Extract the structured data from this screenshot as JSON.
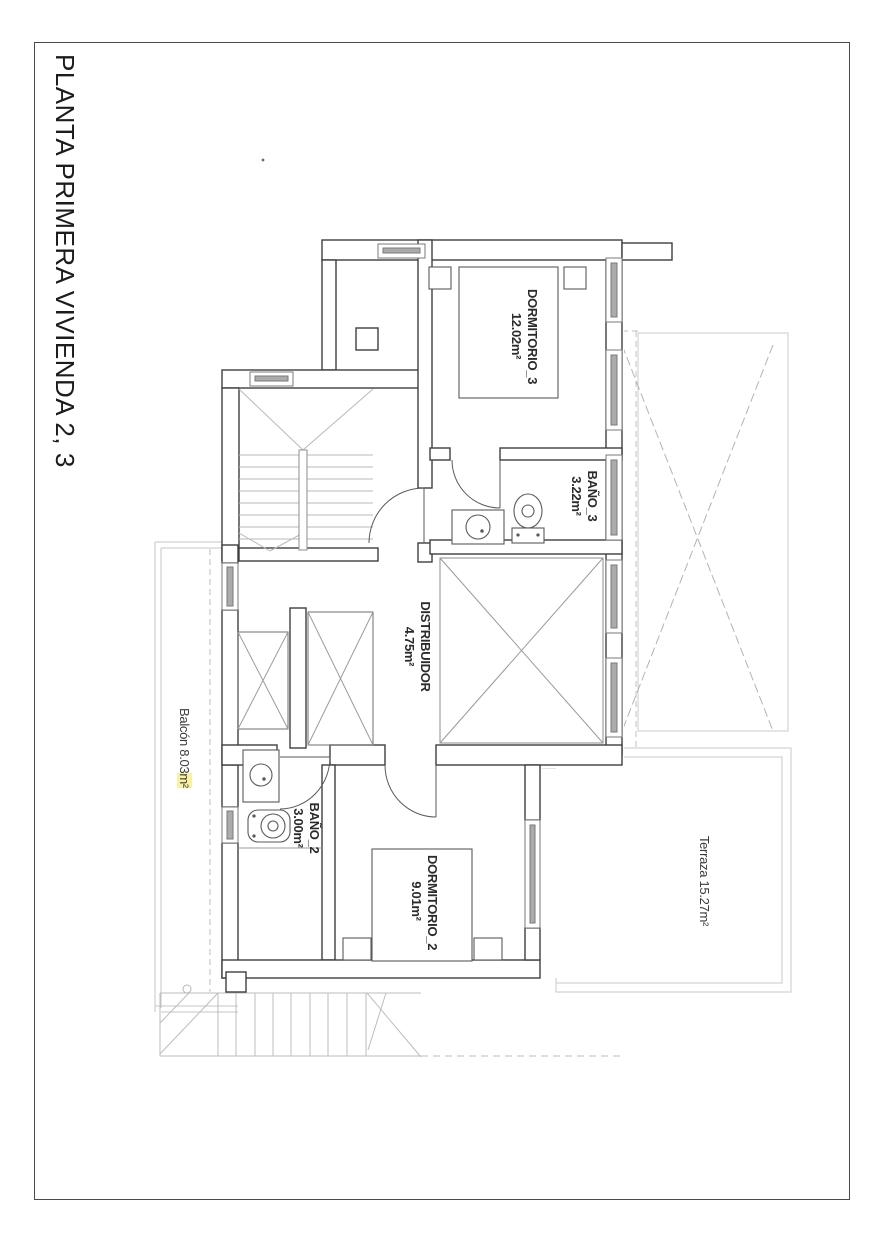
{
  "page": {
    "title": "PLANTA PRIMERA VIVIENDA 2, 3"
  },
  "rooms": {
    "dormitorio3": {
      "name": "DORMITORIO_3",
      "area": "12.02m²"
    },
    "bano3": {
      "name": "BAÑO_3",
      "area": "3.22m²"
    },
    "distribuidor": {
      "name": "DISTRIBUIDOR",
      "area": "4.75m²"
    },
    "bano2": {
      "name": "BAÑO_2",
      "area": "3.00m²"
    },
    "dormitorio2": {
      "name": "DORMITORIO_2",
      "area": "9.01m²"
    },
    "terraza": {
      "name": "Terraza",
      "area": "15.27m²"
    },
    "balcon": {
      "name": "Balcón",
      "area_value": "8.03",
      "area_unit": "m²"
    }
  },
  "colors": {
    "wall": "#3f3f3f",
    "fixture": "#5a5a5a",
    "site_gray": "#c4c4c4",
    "hatch_gray": "#ababab",
    "highlight": "#f8f1a2"
  }
}
